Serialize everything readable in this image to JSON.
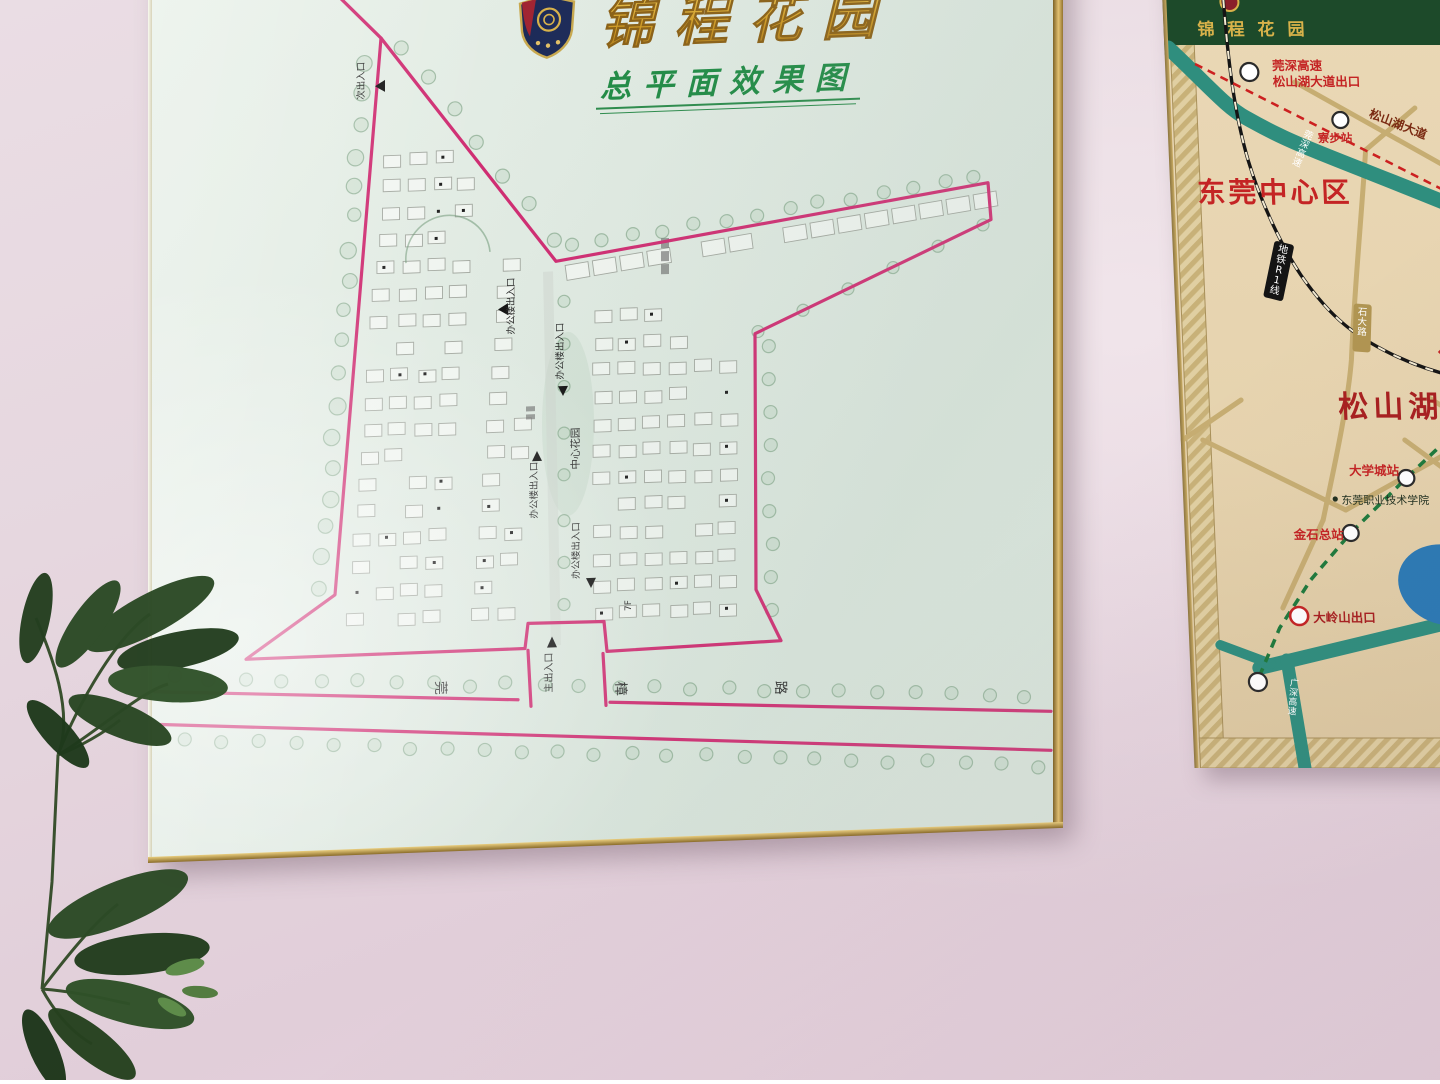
{
  "left_poster": {
    "title": "锦程花园",
    "subtitle": "总平面效果图",
    "labels": {
      "secondary_entrance": "次出入口",
      "office_entrance": "办公楼出入口",
      "central_garden": "中心花园",
      "main_entrance": "主出入口",
      "floor": "7F",
      "road_char_1": "莞",
      "road_char_2": "樟",
      "road_char_3": "路"
    }
  },
  "right_poster": {
    "title": "锦程花园",
    "labels": {
      "city_center": "东莞中心区",
      "songshan_lake": "松山湖",
      "exit_line1": "莞深高速",
      "exit_line2": "松山湖大道出口",
      "liaobu_station": "寮步站",
      "songshanhu_avenue": "松山湖大道",
      "wanshen_expressway": "莞深高速",
      "metro_r1": "地铁R1线",
      "shida_road": "石大路",
      "university_town_station": "大学城站",
      "dongguan_polytechnic": "东莞职业技术学院",
      "jinshi_terminal": "金石总站",
      "dalingshan_exit": "大岭山出口",
      "guangshen_expressway": "广深高速"
    }
  },
  "colors": {
    "boundary_pink": "#cf2d72",
    "title_gold": "#d8a01e",
    "subtitle_green": "#1f8a44",
    "header_green": "#1d4a2a",
    "map_teal": "#2f8e7e",
    "map_red": "#c42424",
    "lake_blue": "#2b7ab5",
    "road_tan": "#c2a96a"
  }
}
